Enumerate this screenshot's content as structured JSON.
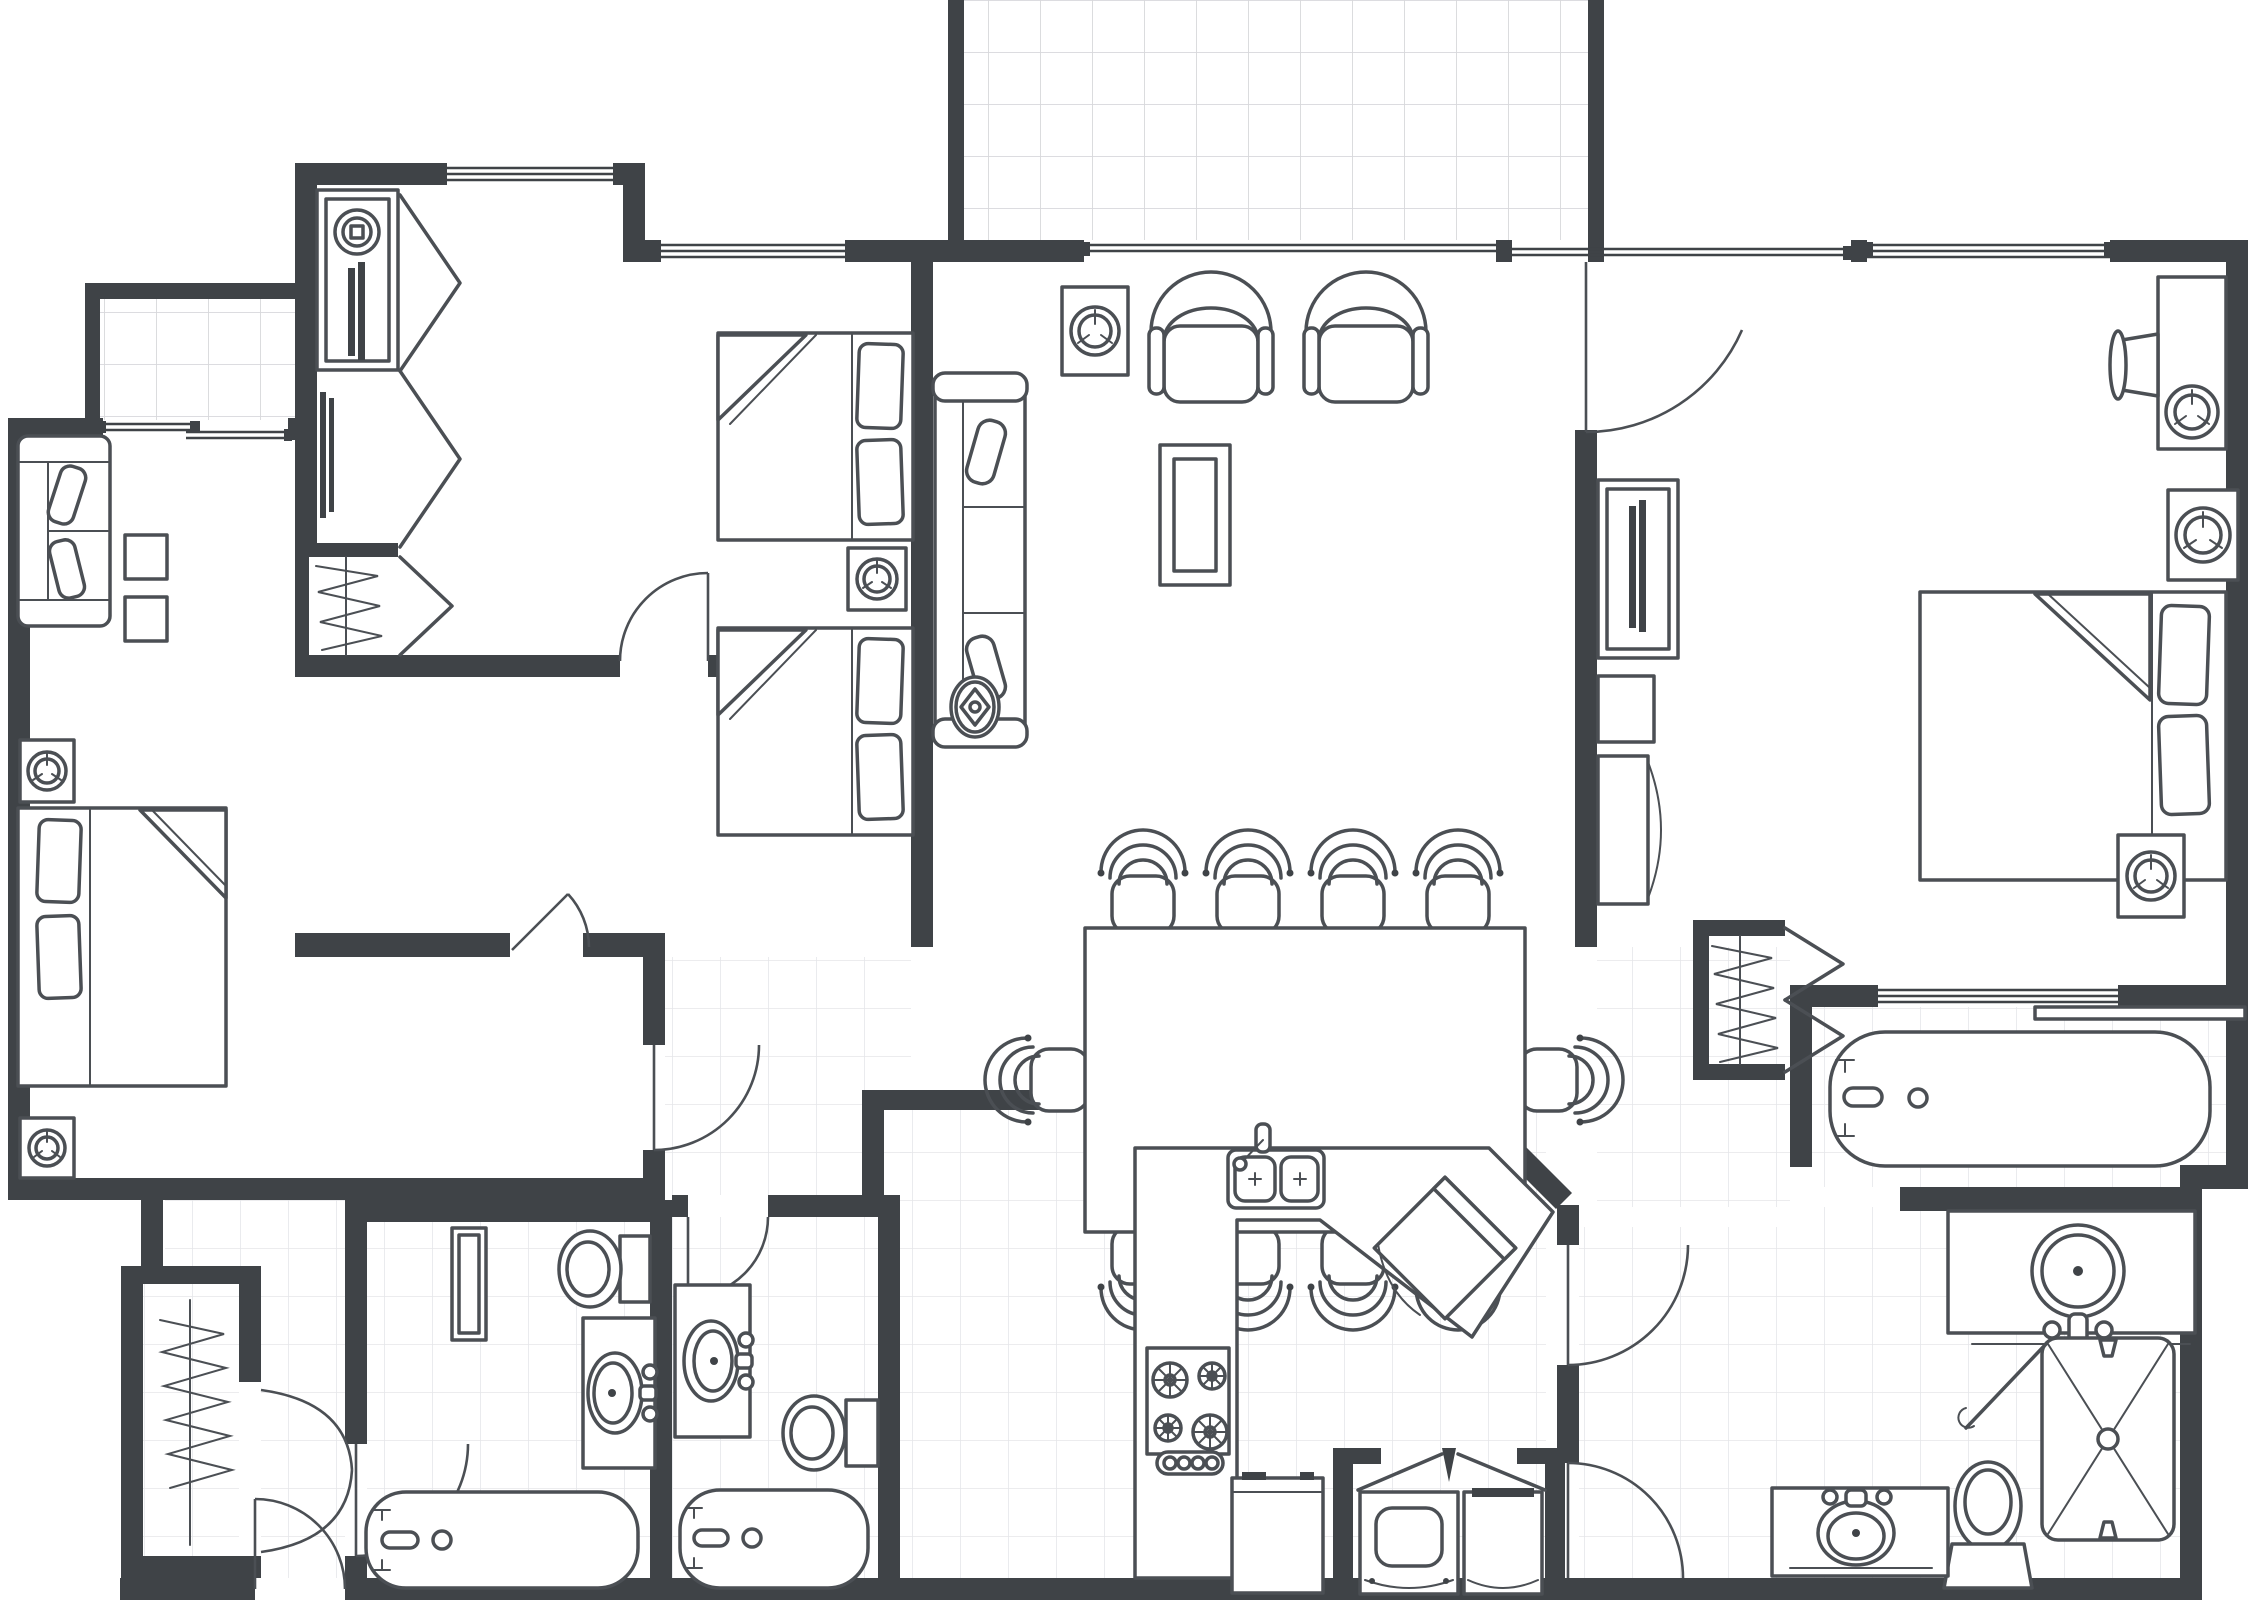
{
  "meta": {
    "type": "architectural-floor-plan",
    "description": "Top-down black-and-white CAD floor plan of a three-bedroom, three-bath apartment suite with open living and dining area, galley kitchen, laundry closet, dressing area, walk-in closets and two tiled balconies",
    "view": "top-down plan view",
    "has_text_labels": false
  },
  "theme": {
    "background": "#ffffff",
    "wall_color": "#3f4347",
    "furniture_line_color": "#4b4f54",
    "tile_line_color": "#d7d8db",
    "tile_line_light": "#e5e6e9",
    "shower_hatch_color": "#c9cacd"
  },
  "rooms": [
    {
      "id": "small-balcony",
      "label": "Small Balcony",
      "floor": "tile"
    },
    {
      "id": "bedroom-1",
      "label": "Bedroom 1",
      "floor": "carpet"
    },
    {
      "id": "bedroom-2",
      "label": "Bedroom 2",
      "floor": "carpet"
    },
    {
      "id": "terrace",
      "label": "Terrace",
      "floor": "tile"
    },
    {
      "id": "living-room",
      "label": "Living Room",
      "floor": "carpet"
    },
    {
      "id": "dining-area",
      "label": "Dining Area",
      "floor": "carpet"
    },
    {
      "id": "hallway",
      "label": "Hallway",
      "floor": "tile"
    },
    {
      "id": "dressing-area",
      "label": "Dressing Area",
      "floor": "carpet"
    },
    {
      "id": "foyer",
      "label": "Foyer",
      "floor": "tile"
    },
    {
      "id": "entry-closet",
      "label": "Entry Closet",
      "floor": "tile"
    },
    {
      "id": "bathroom-1",
      "label": "Bathroom 1",
      "floor": "tile"
    },
    {
      "id": "bathroom-2",
      "label": "Bathroom 2",
      "floor": "tile"
    },
    {
      "id": "kitchen",
      "label": "Kitchen",
      "floor": "tile"
    },
    {
      "id": "laundry-closet",
      "label": "Laundry Closet",
      "floor": "tile"
    },
    {
      "id": "master-hallway",
      "label": "Master Hallway",
      "floor": "tile"
    },
    {
      "id": "walk-in-closet",
      "label": "Walk-in Closet",
      "floor": "tile"
    },
    {
      "id": "master-bathroom",
      "label": "Master Bathroom",
      "floor": "tile"
    },
    {
      "id": "master-bedroom",
      "label": "Master Bedroom",
      "floor": "carpet"
    }
  ],
  "furniture_inventory": {
    "bedroom_1": [
      "loveseat-sofa",
      "side-table",
      "side-table",
      "speaker",
      "double-bed-with-pillows",
      "speaker"
    ],
    "bedroom_2": [
      "tv-armoire-with-speaker",
      "bifold-doors",
      "mirror-panel",
      "hanging-closet",
      "double-bed-with-pillows",
      "double-bed-with-pillows",
      "speaker"
    ],
    "living_room": [
      "speaker",
      "armchair",
      "armchair",
      "sofa",
      "coffee-table",
      "ceiling-fan"
    ],
    "dining_area": [
      "dining-table",
      "dining-chair x10"
    ],
    "kitchen": [
      "double-sink",
      "dishwasher-diagonal",
      "gas-cooktop-4-burner",
      "refrigerator",
      "counter"
    ],
    "laundry_closet": [
      "washer",
      "dryer",
      "bifold-doors"
    ],
    "bathroom_1": [
      "linen-shelf",
      "toilet",
      "vanity-sink",
      "bathtub"
    ],
    "bathroom_2": [
      "vanity-sink",
      "toilet",
      "bathtub"
    ],
    "master_bedroom": [
      "dresser-with-lamp-and-speaker",
      "speaker",
      "speaker",
      "tv-armoire",
      "display-niche",
      "curved-cabinet",
      "king-bed-with-pillows"
    ],
    "walk_in_closet": [
      "clothes-rod",
      "bifold-doors"
    ],
    "master_bathroom": [
      "bathtub",
      "window",
      "vanity-with-round-sink",
      "corner-shower-with-glass-door",
      "toilet",
      "vanity-with-oval-sink"
    ],
    "entry_closet": [
      "clothes-rod",
      "double-doors"
    ]
  },
  "counts": {
    "bedrooms": 3,
    "bathrooms": 3,
    "beds": 4,
    "dining_chairs": 10,
    "armchairs": 2,
    "sofas": 2,
    "speakers": 8,
    "toilets": 3,
    "sinks": 6,
    "bathtubs": 3,
    "showers": 1,
    "balconies": 2,
    "closets": 4,
    "ceiling_fans": 1
  }
}
